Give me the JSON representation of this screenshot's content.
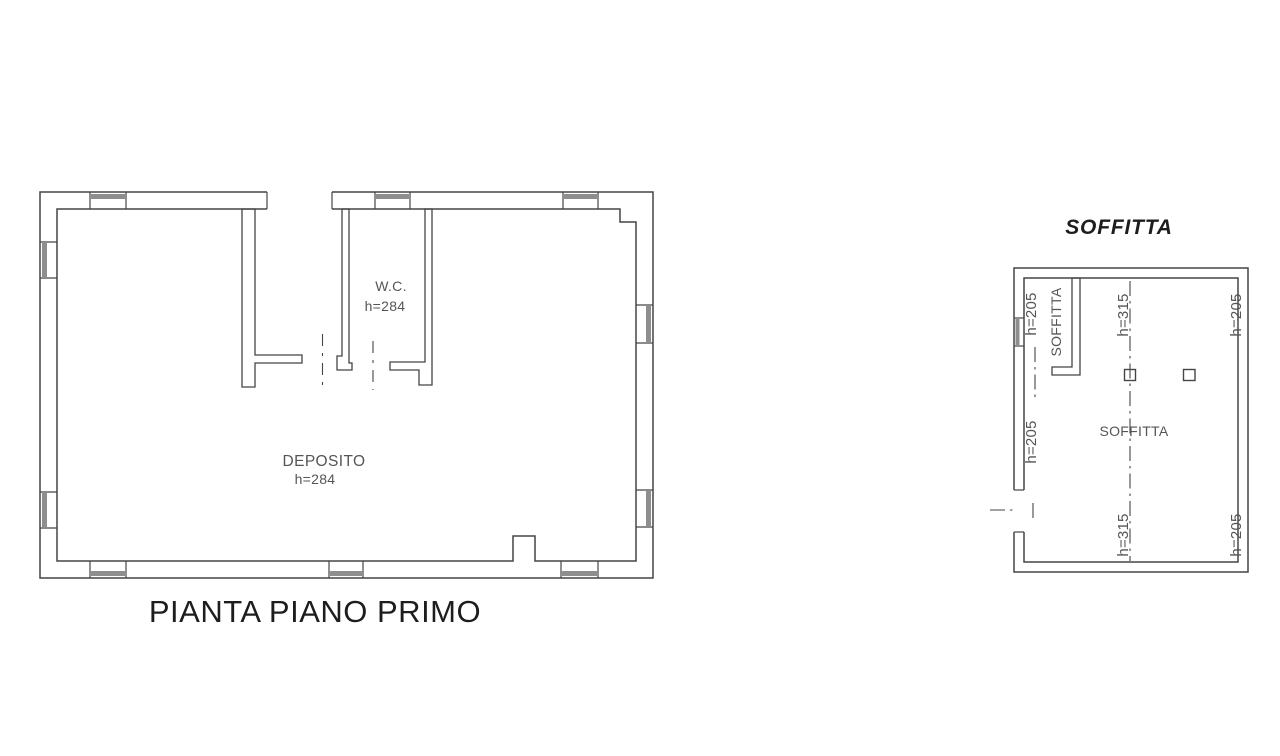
{
  "colors": {
    "line": "#454545",
    "window_glass": "#8e8e8e",
    "label_text": "#555555",
    "title_text": "#1d1d1d",
    "background": "#ffffff"
  },
  "first_floor_plan": {
    "title": "PIANTA PIANO PRIMO",
    "wc_room": {
      "name": "W.C.",
      "height": "h=284"
    },
    "deposito_room": {
      "name": "DEPOSITO",
      "height": "h=284"
    }
  },
  "attic_plan": {
    "title": "SOFFITTA",
    "room_label": "SOFFITTA",
    "small_room_label": "SOFFITTA",
    "heights": {
      "top_left": "h=205",
      "top_center": "h=315",
      "top_right": "h=205",
      "mid_left": "h=205",
      "bottom_center": "h=315",
      "bottom_right": "h=205"
    }
  }
}
